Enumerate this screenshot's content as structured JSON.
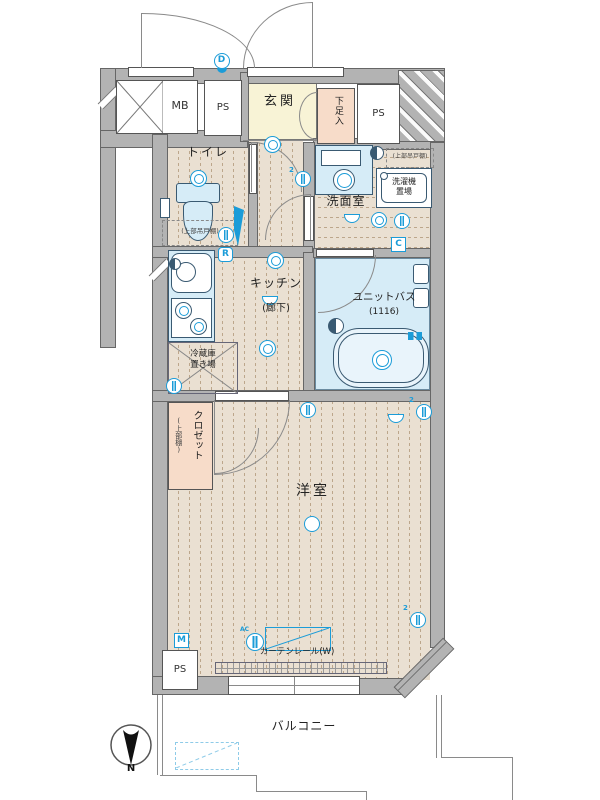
{
  "plan": {
    "labels": {
      "mb": "MB",
      "ps": "PS",
      "genkan": "玄関",
      "shoe": "下足入",
      "toilet": "トイレ",
      "shelf": "(上部吊戸棚)",
      "washroom": "洗面室",
      "washer1": "洗濯機",
      "washer2": "置場",
      "kitchen": "キッチン",
      "kitchen_sub": "(廊下)",
      "bath": "ユニットバス",
      "bath_size": "(1116)",
      "fridge1": "冷蔵庫",
      "fridge2": "置き場",
      "closet": "クロゼット",
      "closet_sub": "(上部棚)",
      "room": "洋室",
      "curtain": "カーテンレール(W)",
      "balcony": "バルコニー",
      "north": "N"
    },
    "markers": {
      "d": "D",
      "r": "R",
      "c": "C",
      "m": "M",
      "ac": "AC",
      "n2": "2"
    },
    "colors": {
      "wall": "#b3b3b3",
      "floor": "#eae0d2",
      "genkan": "#f8f3d6",
      "accent_pink": "#f7dcc9",
      "fixture_blue": "#d6ecf7",
      "symbol_blue": "#1b9cd8",
      "outline": "#555555"
    }
  }
}
